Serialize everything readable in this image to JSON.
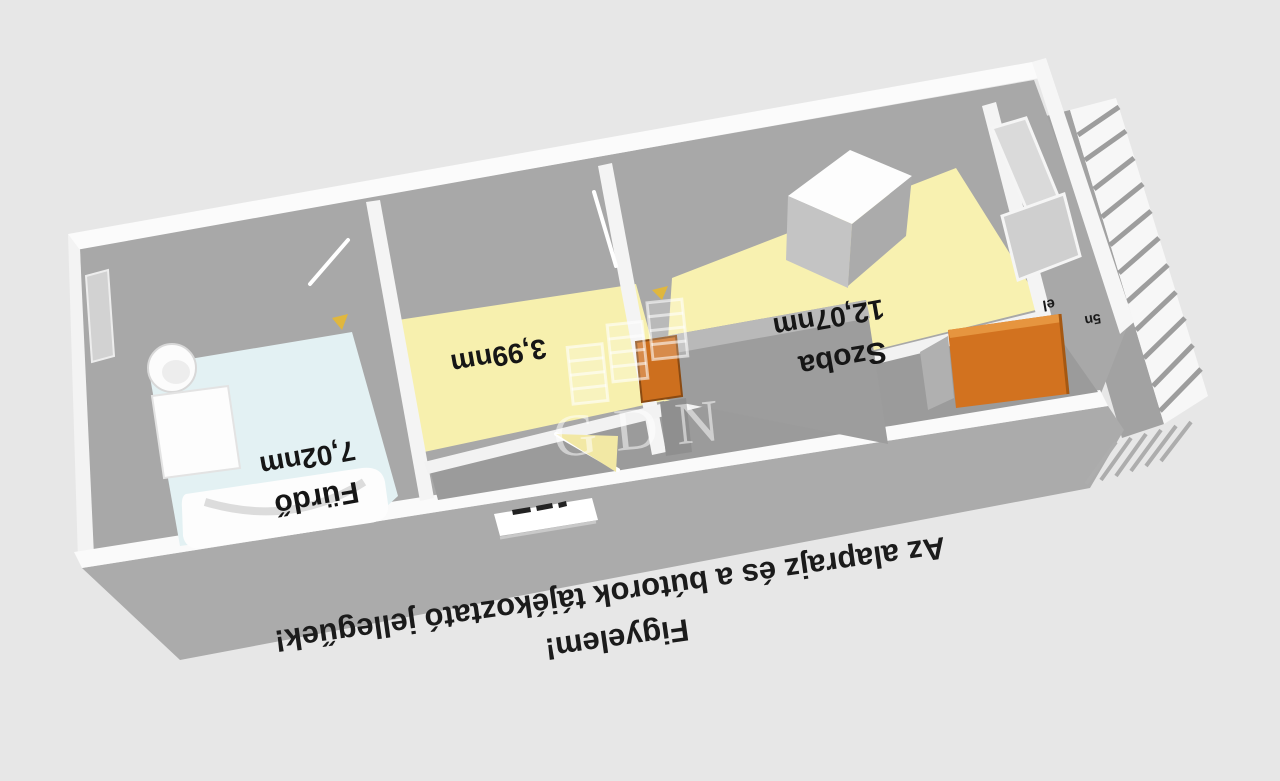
{
  "floorplan": {
    "background": "#e7e7e7",
    "watermark": "GDN",
    "caption_line1": "Figyelem!",
    "caption_line2": "Az alaprajz és a bútorok tájékoztató jellegűek!",
    "rooms": {
      "bathroom": {
        "name": "Fürdő",
        "area": "7,02nm",
        "floor_color": "#e3f1f3"
      },
      "small_room": {
        "area": "3,99nm",
        "floor_color": "#f7f0ae"
      },
      "living_room": {
        "name": "Szoba",
        "area": "12,07nm",
        "floor_color": "#f8f1b0"
      }
    },
    "stair_marks": {
      "mark1": "el",
      "mark2": "5n"
    },
    "colors": {
      "wall_face": "#a8a8a8",
      "wall_top": "#fafafa",
      "corridor_floor": "#9b9b9b",
      "bed_gray": "#9d9d9d",
      "furniture_orange": "#cd6f1e",
      "wardrobe_orange": "#d2721f"
    }
  }
}
